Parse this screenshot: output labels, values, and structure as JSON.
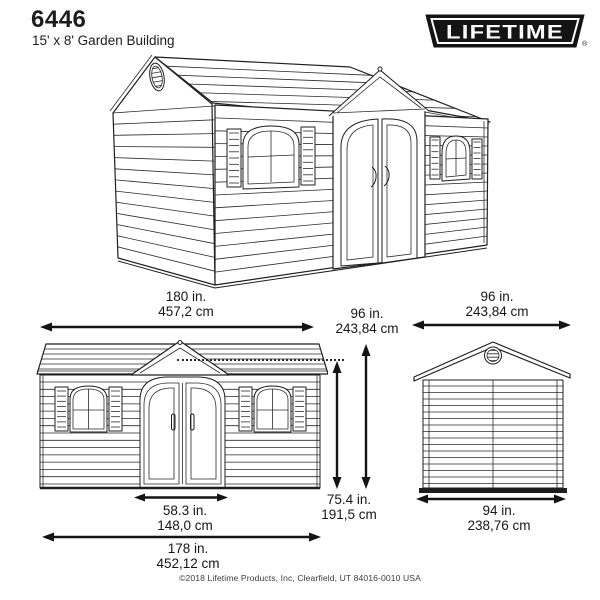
{
  "header": {
    "model_number": "6446",
    "product_name": "15' x 8' Garden Building",
    "brand": "LIFETIME",
    "registered_symbol": "®"
  },
  "dimensions": {
    "overall_width": {
      "inches": "180 in.",
      "metric": "457,2 cm"
    },
    "overall_depth": {
      "inches": "96 in.",
      "metric": "243,84 cm"
    },
    "peak_height": {
      "inches": "96 in.",
      "metric": "243,84 cm"
    },
    "eave_height": {
      "inches": "75.4 in.",
      "metric": "191,5 cm"
    },
    "door_width": {
      "inches": "58.3 in.",
      "metric": "148,0 cm"
    },
    "base_width": {
      "inches": "178 in.",
      "metric": "452,12 cm"
    },
    "base_depth": {
      "inches": "94 in.",
      "metric": "238,76 cm"
    }
  },
  "footer": {
    "copyright": "©2018 Lifetime Products, Inc, Clearfield, UT 84016-0010 USA"
  },
  "colors": {
    "line": "#1f1f1f",
    "logo_black": "#141414",
    "background": "#ffffff"
  }
}
